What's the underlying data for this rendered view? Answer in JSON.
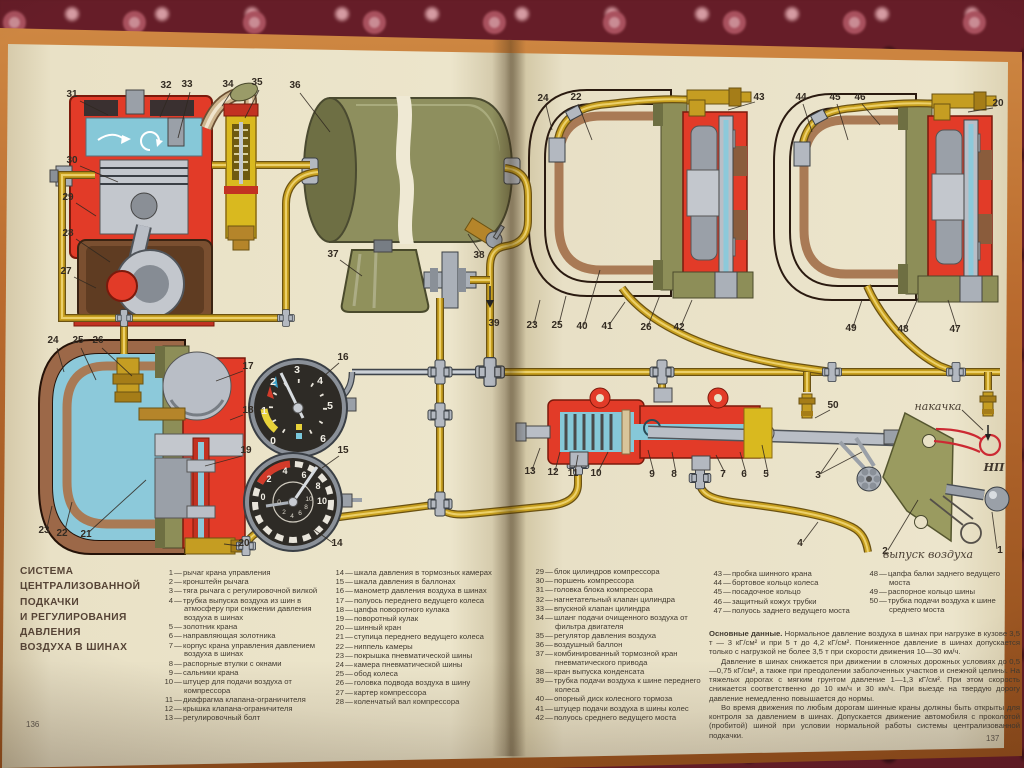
{
  "book": {
    "left_page_number": "136",
    "right_page_number": "137",
    "title_lines": [
      "СИСТЕМА",
      "ЦЕНТРАЛИЗОВАННОЙ",
      "ПОДКАЧКИ",
      "И РЕГУЛИРОВАНИЯ",
      "ДАВЛЕНИЯ",
      "ВОЗДУХА В ШИНАХ"
    ],
    "legend": {
      "col1": [
        {
          "n": "1",
          "t": "рычаг крана управления"
        },
        {
          "n": "2",
          "t": "кронштейн рычага"
        },
        {
          "n": "3",
          "t": "тяга рычага с регулировочной вилкой"
        },
        {
          "n": "4",
          "t": "трубка выпуска воздуха из шин в атмосферу при снижении давления воздуха в шинах"
        },
        {
          "n": "5",
          "t": "золотник крана"
        },
        {
          "n": "6",
          "t": "направляющая золотника"
        },
        {
          "n": "7",
          "t": "корпус крана управления давлением воздуха в шинах"
        },
        {
          "n": "8",
          "t": "распорные втулки с окнами"
        },
        {
          "n": "9",
          "t": "сальники крана"
        },
        {
          "n": "10",
          "t": "штуцер для подачи воздуха от компрессора"
        },
        {
          "n": "11",
          "t": "диафрагма клапана-ограничителя"
        },
        {
          "n": "12",
          "t": "крышка клапана-ограничителя"
        },
        {
          "n": "13",
          "t": "регулировочный болт"
        }
      ],
      "col2": [
        {
          "n": "14",
          "t": "шкала давления в тормозных камерах"
        },
        {
          "n": "15",
          "t": "шкала давления в баллонах"
        },
        {
          "n": "16",
          "t": "манометр давления воздуха в шинах"
        },
        {
          "n": "17",
          "t": "полуось переднего ведущего колеса"
        },
        {
          "n": "18",
          "t": "цапфа поворотного кулака"
        },
        {
          "n": "19",
          "t": "поворотный кулак"
        },
        {
          "n": "20",
          "t": "шинный кран"
        },
        {
          "n": "21",
          "t": "ступица переднего ведущего колеса"
        },
        {
          "n": "22",
          "t": "ниппель камеры"
        },
        {
          "n": "23",
          "t": "покрышка пневматической шины"
        },
        {
          "n": "24",
          "t": "камера пневматической шины"
        },
        {
          "n": "25",
          "t": "обод колеса"
        },
        {
          "n": "26",
          "t": "головка подвода воздуха в шину"
        },
        {
          "n": "27",
          "t": "картер компрессора"
        },
        {
          "n": "28",
          "t": "коленчатый вал компрессора"
        }
      ],
      "col3": [
        {
          "n": "29",
          "t": "блок цилиндров компрессора"
        },
        {
          "n": "30",
          "t": "поршень компрессора"
        },
        {
          "n": "31",
          "t": "головка блока компрессора"
        },
        {
          "n": "32",
          "t": "нагнетательный клапан цилиндра"
        },
        {
          "n": "33",
          "t": "впускной клапан цилиндра"
        },
        {
          "n": "34",
          "t": "шланг подачи очищенного воздуха от фильтра двигателя"
        },
        {
          "n": "35",
          "t": "регулятор давления воздуха"
        },
        {
          "n": "36",
          "t": "воздушный баллон"
        },
        {
          "n": "37",
          "t": "комбинированный тормозной кран пневматического привода"
        },
        {
          "n": "38",
          "t": "кран выпуска конденсата"
        },
        {
          "n": "39",
          "t": "трубка подачи воздуха к шине переднего колеса"
        },
        {
          "n": "40",
          "t": "опорный диск колесного тормоза"
        },
        {
          "n": "41",
          "t": "штуцер подачи воздуха в шины колес"
        },
        {
          "n": "42",
          "t": "полуось среднего ведущего моста"
        }
      ],
      "col4": [
        {
          "n": "43",
          "t": "пробка шинного крана"
        },
        {
          "n": "44",
          "t": "бортовое кольцо колеса"
        },
        {
          "n": "45",
          "t": "посадочное кольцо"
        },
        {
          "n": "46",
          "t": "защитный кожух трубки"
        },
        {
          "n": "47",
          "t": "полуось заднего ведущего моста"
        }
      ],
      "col5": [
        {
          "n": "48",
          "t": "цапфа балки заднего ведущего моста"
        },
        {
          "n": "49",
          "t": "распорное кольцо шины"
        },
        {
          "n": "50",
          "t": "трубка подачи воздуха к шине среднего моста"
        }
      ]
    },
    "main_text": {
      "lead": "Основные данные.",
      "p1": " Нормальное давление воздуха в шинах при нагрузке в кузове 3,5 т — 3 кГ/см² и при 5 т до 4,2 кГ/см². Пониженное давление в шинах допускается только с нагрузкой не более 3,5 т при скорости движения 10—30 км/ч.",
      "p2": "Давление в шинах снижается при движении в сложных дорожных условиях до 0,5—0,75 кГ/см², а также при преодолении заболоченных участков и снежной целины. На тяжелых дорогах с мягким грунтом давление 1—1,3 кГ/см². При этом скорость снижается соответственно до 10 км/ч и 30 км/ч. При выезде на твердую дорогу давление немедленно повышается до нормы.",
      "p3": "Во время движения по любым дорогам шинные краны должны быть открыты для контроля за давлением в шинах. Допускается движение автомобиля с проколотой (пробитой) шиной при условии нормальной работы системы централизованной подкачки."
    }
  },
  "diagram": {
    "labels": {
      "inflate": "накачка",
      "neutral": "НП",
      "release": "выпуск воздуха"
    },
    "gauge_tire": {
      "ticks": [
        "0",
        "1",
        "2",
        "3",
        "4",
        "5",
        "6"
      ]
    },
    "gauge_dual": {
      "outer": [
        "0",
        "2",
        "4",
        "6",
        "8",
        "10"
      ],
      "inner": [
        "0",
        "2",
        "4",
        "6",
        "8",
        "10"
      ]
    },
    "callout_numbers": [
      "31",
      "30",
      "29",
      "28",
      "27",
      "32",
      "33",
      "34",
      "35",
      "36",
      "37",
      "38",
      "39",
      "24",
      "25",
      "26",
      "17",
      "18",
      "19",
      "23",
      "22",
      "21",
      "20",
      "16",
      "15",
      "14",
      "24",
      "22",
      "43",
      "23",
      "25",
      "40",
      "41",
      "26",
      "42",
      "44",
      "45",
      "46",
      "20",
      "49",
      "48",
      "47",
      "13",
      "12",
      "11",
      "10",
      "9",
      "8",
      "7",
      "6",
      "5",
      "3",
      "50",
      "2",
      "1",
      "4"
    ],
    "colors": {
      "red": "#e23b28",
      "cyan": "#86c8d8",
      "olive": "#8d8e58",
      "gold": "#c59d22",
      "page": "#e9e1c6"
    }
  }
}
